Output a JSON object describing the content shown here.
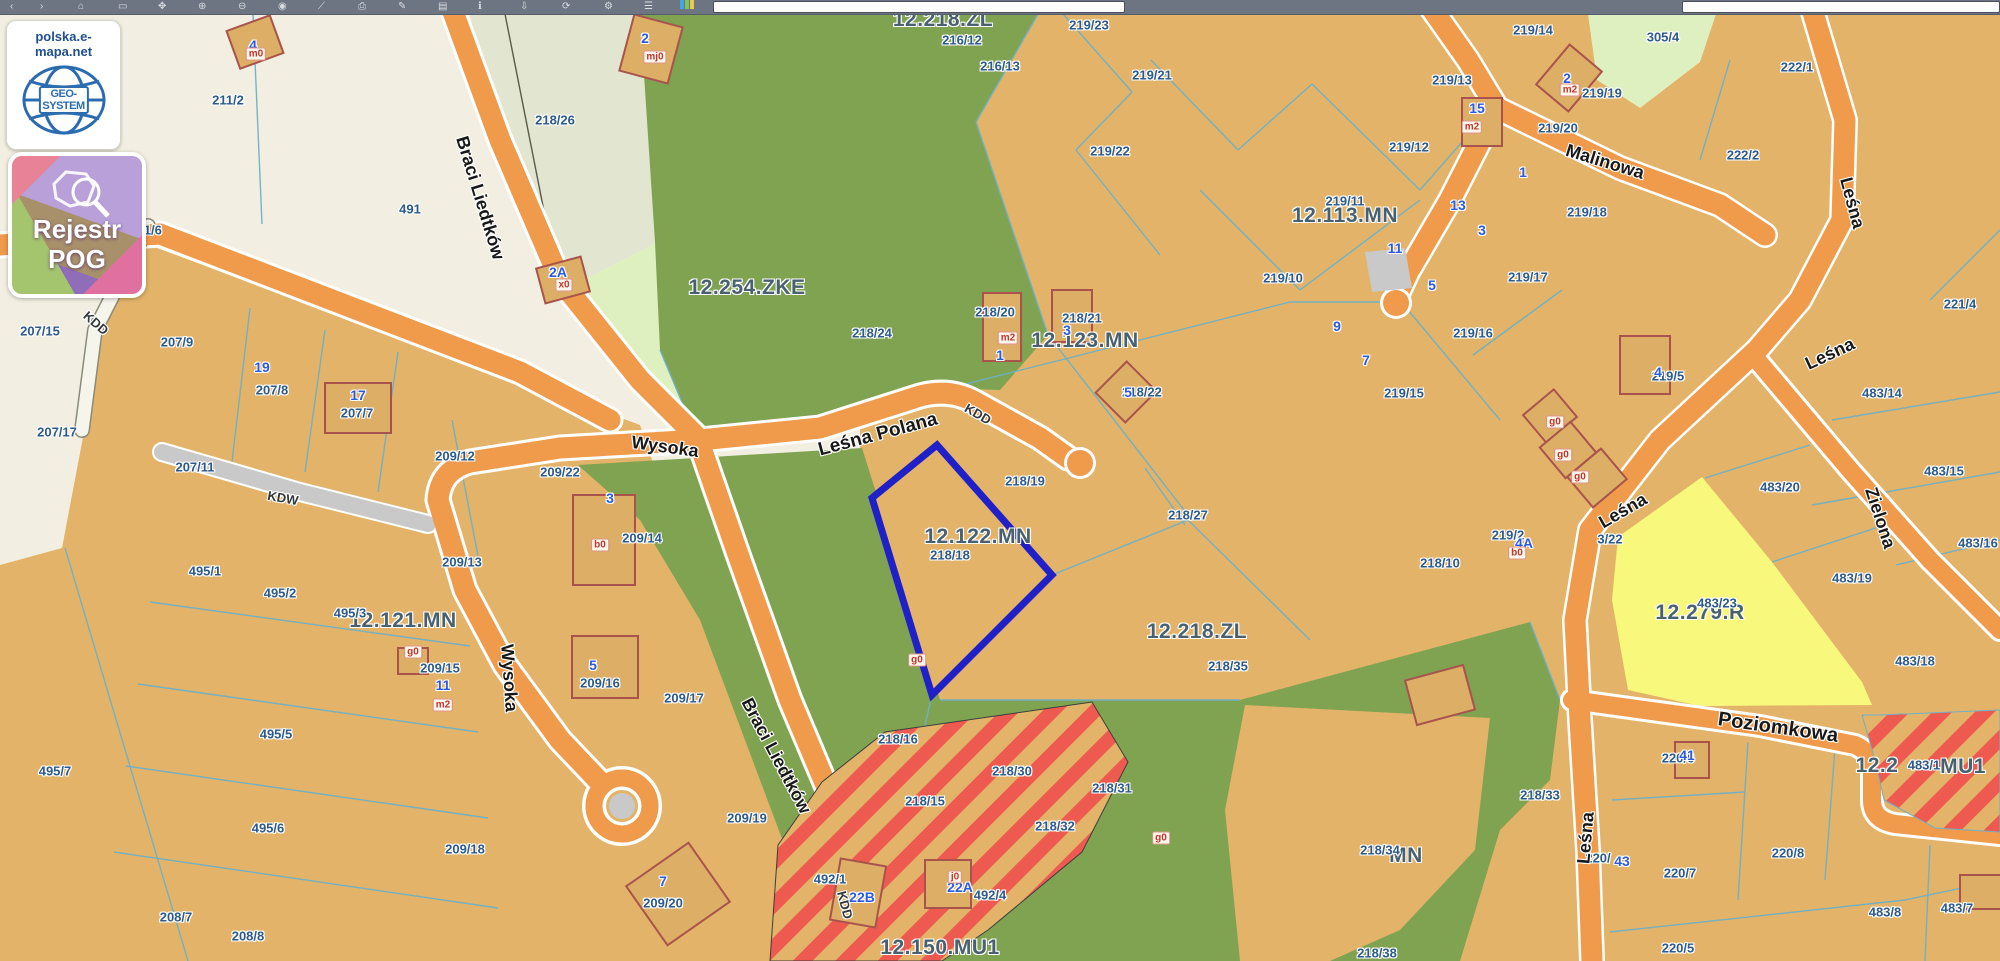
{
  "toolbar": {
    "icons": [
      {
        "name": "back-icon",
        "glyph": "‹",
        "x": 10
      },
      {
        "name": "forward-icon",
        "glyph": "›",
        "x": 40
      },
      {
        "name": "home-icon",
        "glyph": "⌂",
        "x": 78
      },
      {
        "name": "select-rect-icon",
        "glyph": "▭",
        "x": 118
      },
      {
        "name": "pan-icon",
        "glyph": "✥",
        "x": 158
      },
      {
        "name": "zoom-in-icon",
        "glyph": "⊕",
        "x": 198
      },
      {
        "name": "zoom-out-icon",
        "glyph": "⊖",
        "x": 238
      },
      {
        "name": "marker-icon",
        "glyph": "◉",
        "x": 278
      },
      {
        "name": "measure-icon",
        "glyph": "⟋",
        "x": 318
      },
      {
        "name": "print-icon",
        "glyph": "⎙",
        "x": 358
      },
      {
        "name": "draw-icon",
        "glyph": "✎",
        "x": 398
      },
      {
        "name": "layers-icon",
        "glyph": "▤",
        "x": 438
      },
      {
        "name": "info-icon",
        "glyph": "ℹ",
        "x": 478
      },
      {
        "name": "download-icon",
        "glyph": "⇩",
        "x": 520
      },
      {
        "name": "refresh-icon",
        "glyph": "⟳",
        "x": 562
      },
      {
        "name": "settings-icon",
        "glyph": "⚙",
        "x": 604
      },
      {
        "name": "menu-icon",
        "glyph": "☰",
        "x": 644
      }
    ],
    "palette_colors": [
      "#4aa3df",
      "#7dc855",
      "#e8c94a"
    ],
    "search_left_value": "",
    "search_right_value": ""
  },
  "overlay": {
    "site_label": "polska.e-mapa.net",
    "logo_text": "GEO-SYSTEM",
    "badge_line1": "Rejestr",
    "badge_line2": "POG"
  },
  "map": {
    "selected_parcel": {
      "id": "218/18",
      "zone": "12.122.MN",
      "outline": [
        [
          937,
          431
        ],
        [
          1052,
          561
        ],
        [
          932,
          681
        ],
        [
          872,
          484
        ]
      ]
    },
    "colors": {
      "cream": "#f2efe2",
      "sage": "#e2e5d0",
      "lime": "#dff0c0",
      "tan": "#e2b369",
      "forest": "#7fa351",
      "road_orange": "#f09a4b",
      "road_gray": "#c9c9c9",
      "yellow": "#f8f87d",
      "stripe_red": "#ee5a50",
      "boundary": "#6fb0c6",
      "selection": "#2020c8",
      "parcel_text": "#2c5a8a",
      "zone_text": "#49616f",
      "badge_blue": "#2b5ae0",
      "chip_red": "#c03730",
      "toolbar": "#6e7582"
    },
    "labels": [
      {
        "t": "zone",
        "text": "12.218.ZL",
        "x": 943,
        "y": 6
      },
      {
        "t": "zone",
        "text": "12.254.ZKE",
        "x": 747,
        "y": 274
      },
      {
        "t": "zone",
        "text": "12.123.MN",
        "x": 1085,
        "y": 327
      },
      {
        "t": "zone",
        "text": "12.113.MN",
        "x": 1345,
        "y": 202
      },
      {
        "t": "zone",
        "text": "12.122.MN",
        "x": 978,
        "y": 523
      },
      {
        "t": "zone",
        "text": "12.121.MN",
        "x": 403,
        "y": 607
      },
      {
        "t": "zone",
        "text": "12.218.ZL",
        "x": 1197,
        "y": 618
      },
      {
        "t": "zone",
        "text": "12.279.R",
        "x": 1700,
        "y": 599
      },
      {
        "t": "zone",
        "text": "12.150.MU1",
        "x": 940,
        "y": 934
      },
      {
        "t": "zone",
        "text": "12.2",
        "x": 1877,
        "y": 752
      },
      {
        "t": "zone",
        "text": "MU1",
        "x": 1963,
        "y": 753
      },
      {
        "t": "zone",
        "text": "MN",
        "x": 1406,
        "y": 842
      },
      {
        "t": "parcel",
        "text": "211/2",
        "x": 228,
        "y": 86
      },
      {
        "t": "parcel",
        "text": "211/6",
        "x": 146,
        "y": 216
      },
      {
        "t": "parcel",
        "text": "491",
        "x": 410,
        "y": 195
      },
      {
        "t": "parcel",
        "text": "218/26",
        "x": 555,
        "y": 106
      },
      {
        "t": "parcel",
        "text": "207/15",
        "x": 40,
        "y": 317
      },
      {
        "t": "parcel",
        "text": "207/9",
        "x": 177,
        "y": 328
      },
      {
        "t": "parcel",
        "text": "207/8",
        "x": 272,
        "y": 376
      },
      {
        "t": "parcel",
        "text": "207/7",
        "x": 357,
        "y": 399
      },
      {
        "t": "parcel",
        "text": "207/17",
        "x": 57,
        "y": 418
      },
      {
        "t": "parcel",
        "text": "207/11",
        "x": 195,
        "y": 453
      },
      {
        "t": "parcel",
        "text": "209/12",
        "x": 455,
        "y": 442
      },
      {
        "t": "parcel",
        "text": "209/22",
        "x": 560,
        "y": 458
      },
      {
        "t": "parcel",
        "text": "209/13",
        "x": 462,
        "y": 548
      },
      {
        "t": "parcel",
        "text": "209/14",
        "x": 642,
        "y": 524
      },
      {
        "t": "parcel",
        "text": "209/15",
        "x": 440,
        "y": 654
      },
      {
        "t": "parcel",
        "text": "209/16",
        "x": 600,
        "y": 669
      },
      {
        "t": "parcel",
        "text": "209/17",
        "x": 684,
        "y": 684
      },
      {
        "t": "parcel",
        "text": "209/18",
        "x": 465,
        "y": 835
      },
      {
        "t": "parcel",
        "text": "209/19",
        "x": 747,
        "y": 804
      },
      {
        "t": "parcel",
        "text": "209/20",
        "x": 663,
        "y": 889
      },
      {
        "t": "parcel",
        "text": "495/1",
        "x": 205,
        "y": 557
      },
      {
        "t": "parcel",
        "text": "495/2",
        "x": 280,
        "y": 579
      },
      {
        "t": "parcel",
        "text": "495/3",
        "x": 350,
        "y": 599
      },
      {
        "t": "parcel",
        "text": "495/5",
        "x": 276,
        "y": 720
      },
      {
        "t": "parcel",
        "text": "495/6",
        "x": 268,
        "y": 814
      },
      {
        "t": "parcel",
        "text": "495/7",
        "x": 55,
        "y": 757
      },
      {
        "t": "parcel",
        "text": "208/7",
        "x": 176,
        "y": 903
      },
      {
        "t": "parcel",
        "text": "208/8",
        "x": 248,
        "y": 922
      },
      {
        "t": "parcel",
        "text": "216/12",
        "x": 962,
        "y": 26
      },
      {
        "t": "parcel",
        "text": "216/13",
        "x": 1000,
        "y": 52
      },
      {
        "t": "parcel",
        "text": "219/23",
        "x": 1089,
        "y": 11
      },
      {
        "t": "parcel",
        "text": "219/21",
        "x": 1152,
        "y": 61
      },
      {
        "t": "parcel",
        "text": "219/22",
        "x": 1110,
        "y": 137
      },
      {
        "t": "parcel",
        "text": "219/12",
        "x": 1409,
        "y": 133
      },
      {
        "t": "parcel",
        "text": "219/13",
        "x": 1452,
        "y": 66
      },
      {
        "t": "parcel",
        "text": "219/14",
        "x": 1533,
        "y": 16
      },
      {
        "t": "parcel",
        "text": "219/19",
        "x": 1602,
        "y": 79
      },
      {
        "t": "parcel",
        "text": "219/20",
        "x": 1558,
        "y": 114
      },
      {
        "t": "parcel",
        "text": "305/4",
        "x": 1663,
        "y": 23
      },
      {
        "t": "parcel",
        "text": "222/1",
        "x": 1797,
        "y": 53
      },
      {
        "t": "parcel",
        "text": "222/2",
        "x": 1743,
        "y": 141
      },
      {
        "t": "parcel",
        "text": "219/11",
        "x": 1345,
        "y": 187
      },
      {
        "t": "parcel",
        "text": "219/18",
        "x": 1587,
        "y": 198
      },
      {
        "t": "parcel",
        "text": "219/17",
        "x": 1528,
        "y": 263
      },
      {
        "t": "parcel",
        "text": "219/10",
        "x": 1283,
        "y": 264
      },
      {
        "t": "parcel",
        "text": "219/16",
        "x": 1473,
        "y": 319
      },
      {
        "t": "parcel",
        "text": "219/15",
        "x": 1404,
        "y": 379
      },
      {
        "t": "parcel",
        "text": "218/24",
        "x": 872,
        "y": 319
      },
      {
        "t": "parcel",
        "text": "218/20",
        "x": 995,
        "y": 298
      },
      {
        "t": "parcel",
        "text": "218/21",
        "x": 1082,
        "y": 304
      },
      {
        "t": "parcel",
        "text": "218/22",
        "x": 1142,
        "y": 378
      },
      {
        "t": "parcel",
        "text": "218/19",
        "x": 1025,
        "y": 467
      },
      {
        "t": "parcel",
        "text": "218/27",
        "x": 1188,
        "y": 501
      },
      {
        "t": "parcel",
        "text": "218/18",
        "x": 950,
        "y": 541
      },
      {
        "t": "parcel",
        "text": "218/10",
        "x": 1440,
        "y": 549
      },
      {
        "t": "parcel",
        "text": "219/2",
        "x": 1508,
        "y": 521
      },
      {
        "t": "parcel",
        "text": "219/5",
        "x": 1668,
        "y": 362
      },
      {
        "t": "parcel",
        "text": "3/22",
        "x": 1610,
        "y": 525
      },
      {
        "t": "parcel",
        "text": "221/4",
        "x": 1960,
        "y": 290
      },
      {
        "t": "parcel",
        "text": "483/14",
        "x": 1882,
        "y": 379
      },
      {
        "t": "parcel",
        "text": "483/15",
        "x": 1944,
        "y": 457
      },
      {
        "t": "parcel",
        "text": "483/16",
        "x": 1978,
        "y": 529
      },
      {
        "t": "parcel",
        "text": "483/20",
        "x": 1780,
        "y": 473
      },
      {
        "t": "parcel",
        "text": "483/19",
        "x": 1852,
        "y": 564
      },
      {
        "t": "parcel",
        "text": "483/23",
        "x": 1717,
        "y": 589
      },
      {
        "t": "parcel",
        "text": "483/18",
        "x": 1915,
        "y": 647
      },
      {
        "t": "parcel",
        "text": "218/16",
        "x": 898,
        "y": 725
      },
      {
        "t": "parcel",
        "text": "218/15",
        "x": 925,
        "y": 787
      },
      {
        "t": "parcel",
        "text": "218/30",
        "x": 1012,
        "y": 757
      },
      {
        "t": "parcel",
        "text": "218/31",
        "x": 1112,
        "y": 774
      },
      {
        "t": "parcel",
        "text": "218/32",
        "x": 1055,
        "y": 812
      },
      {
        "t": "parcel",
        "text": "218/35",
        "x": 1228,
        "y": 652
      },
      {
        "t": "parcel",
        "text": "218/33",
        "x": 1540,
        "y": 781
      },
      {
        "t": "parcel",
        "text": "218/34",
        "x": 1380,
        "y": 836
      },
      {
        "t": "parcel",
        "text": "218/38",
        "x": 1377,
        "y": 939
      },
      {
        "t": "parcel",
        "text": "492/1",
        "x": 830,
        "y": 865
      },
      {
        "t": "parcel",
        "text": "492/4",
        "x": 990,
        "y": 881
      },
      {
        "t": "parcel",
        "text": "483/1",
        "x": 1924,
        "y": 751
      },
      {
        "t": "parcel",
        "text": "220/6",
        "x": 1678,
        "y": 744
      },
      {
        "t": "parcel",
        "text": "220/7",
        "x": 1680,
        "y": 859
      },
      {
        "t": "parcel",
        "text": "220/8",
        "x": 1788,
        "y": 839
      },
      {
        "t": "parcel",
        "text": "220/5",
        "x": 1678,
        "y": 934
      },
      {
        "t": "parcel",
        "text": "220/",
        "x": 1598,
        "y": 844
      },
      {
        "t": "parcel",
        "text": "483/8",
        "x": 1885,
        "y": 898
      },
      {
        "t": "parcel",
        "text": "483/7",
        "x": 1957,
        "y": 894
      },
      {
        "t": "street",
        "text": "Braci Liedtków",
        "x": 480,
        "y": 184,
        "r": 73,
        "s": 18
      },
      {
        "t": "street",
        "text": "Braci Liedtków",
        "x": 776,
        "y": 742,
        "r": 62,
        "s": 18
      },
      {
        "t": "street",
        "text": "Wysoka",
        "x": 665,
        "y": 433,
        "r": 8,
        "s": 18
      },
      {
        "t": "street",
        "text": "Wysoka",
        "x": 509,
        "y": 664,
        "r": 86,
        "s": 18
      },
      {
        "t": "street",
        "text": "Leśna Polana",
        "x": 878,
        "y": 421,
        "r": -15,
        "s": 19
      },
      {
        "t": "street",
        "text": "Malinowa",
        "x": 1605,
        "y": 148,
        "r": 17,
        "s": 18
      },
      {
        "t": "street",
        "text": "Leśna",
        "x": 1852,
        "y": 189,
        "r": 75,
        "s": 18
      },
      {
        "t": "street",
        "text": "Leśna",
        "x": 1830,
        "y": 340,
        "r": -25,
        "s": 18
      },
      {
        "t": "street",
        "text": "Leśna",
        "x": 1623,
        "y": 497,
        "r": -30,
        "s": 18
      },
      {
        "t": "street",
        "text": "Leśna",
        "x": 1586,
        "y": 824,
        "r": -85,
        "s": 18
      },
      {
        "t": "street",
        "text": "Zielona",
        "x": 1880,
        "y": 504,
        "r": 72,
        "s": 18
      },
      {
        "t": "street",
        "text": "Poziomkowa",
        "x": 1778,
        "y": 714,
        "r": 8,
        "s": 20
      },
      {
        "t": "road",
        "text": "KDD",
        "x": 96,
        "y": 309,
        "r": 41
      },
      {
        "t": "road",
        "text": "KDW",
        "x": 283,
        "y": 484,
        "r": 10
      },
      {
        "t": "road",
        "text": "KDD",
        "x": 978,
        "y": 400,
        "r": 30
      },
      {
        "t": "road",
        "text": "KDD",
        "x": 845,
        "y": 891,
        "r": 75
      },
      {
        "t": "badge",
        "text": "4",
        "x": 253,
        "y": 31
      },
      {
        "t": "badge",
        "text": "2",
        "x": 645,
        "y": 24
      },
      {
        "t": "badge",
        "text": "2A",
        "x": 558,
        "y": 258
      },
      {
        "t": "badge",
        "text": "19",
        "x": 262,
        "y": 353
      },
      {
        "t": "badge",
        "text": "17",
        "x": 358,
        "y": 381
      },
      {
        "t": "badge",
        "text": "3",
        "x": 610,
        "y": 484
      },
      {
        "t": "badge",
        "text": "5",
        "x": 593,
        "y": 651
      },
      {
        "t": "badge",
        "text": "11",
        "x": 443,
        "y": 671
      },
      {
        "t": "badge",
        "text": "7",
        "x": 663,
        "y": 867
      },
      {
        "t": "badge",
        "text": "1",
        "x": 1000,
        "y": 341
      },
      {
        "t": "badge",
        "text": "3",
        "x": 1067,
        "y": 316
      },
      {
        "t": "badge",
        "text": "5",
        "x": 1128,
        "y": 378
      },
      {
        "t": "badge",
        "text": "15",
        "x": 1477,
        "y": 94
      },
      {
        "t": "badge",
        "text": "2",
        "x": 1567,
        "y": 64
      },
      {
        "t": "badge",
        "text": "1",
        "x": 1523,
        "y": 158
      },
      {
        "t": "badge",
        "text": "13",
        "x": 1458,
        "y": 191
      },
      {
        "t": "badge",
        "text": "3",
        "x": 1482,
        "y": 216
      },
      {
        "t": "badge",
        "text": "11",
        "x": 1395,
        "y": 234
      },
      {
        "t": "badge",
        "text": "5",
        "x": 1432,
        "y": 271
      },
      {
        "t": "badge",
        "text": "9",
        "x": 1337,
        "y": 312
      },
      {
        "t": "badge",
        "text": "7",
        "x": 1366,
        "y": 346
      },
      {
        "t": "badge",
        "text": "4A",
        "x": 1524,
        "y": 529
      },
      {
        "t": "badge",
        "text": "4",
        "x": 1658,
        "y": 358
      },
      {
        "t": "badge",
        "text": "41",
        "x": 1687,
        "y": 741
      },
      {
        "t": "badge",
        "text": "43",
        "x": 1622,
        "y": 847
      },
      {
        "t": "badge",
        "text": "22B",
        "x": 862,
        "y": 883
      },
      {
        "t": "badge",
        "text": "22A",
        "x": 960,
        "y": 873
      },
      {
        "t": "chip",
        "text": "m0",
        "x": 256,
        "y": 40
      },
      {
        "t": "chip",
        "text": "mj0",
        "x": 655,
        "y": 43
      },
      {
        "t": "chip",
        "text": "x0",
        "x": 564,
        "y": 271
      },
      {
        "t": "chip",
        "text": "b0",
        "x": 600,
        "y": 531
      },
      {
        "t": "chip",
        "text": "m2",
        "x": 1008,
        "y": 324
      },
      {
        "t": "chip",
        "text": "m2",
        "x": 1472,
        "y": 113
      },
      {
        "t": "chip",
        "text": "m2",
        "x": 1570,
        "y": 76
      },
      {
        "t": "chip",
        "text": "g0",
        "x": 1555,
        "y": 408
      },
      {
        "t": "chip",
        "text": "g0",
        "x": 1563,
        "y": 441
      },
      {
        "t": "chip",
        "text": "g0",
        "x": 1580,
        "y": 463
      },
      {
        "t": "chip",
        "text": "b0",
        "x": 1517,
        "y": 539
      },
      {
        "t": "chip",
        "text": "g0",
        "x": 413,
        "y": 638
      },
      {
        "t": "chip",
        "text": "m2",
        "x": 443,
        "y": 691
      },
      {
        "t": "chip",
        "text": "g0",
        "x": 917,
        "y": 646
      },
      {
        "t": "chip",
        "text": "g0",
        "x": 1161,
        "y": 824
      },
      {
        "t": "chip",
        "text": "j0",
        "x": 955,
        "y": 863
      }
    ]
  }
}
